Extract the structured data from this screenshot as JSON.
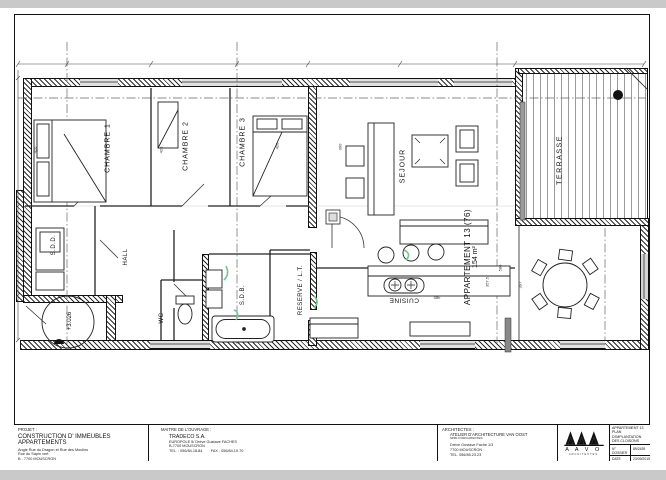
{
  "plan": {
    "rooms": {
      "chambre1": "CHAMBRE 1",
      "chambre2": "CHAMBRE 2",
      "chambre3": "CHAMBRE 3",
      "sejour": "SEJOUR",
      "terrasse": "TERRASSE",
      "hall": "HALL",
      "sdd": "S.D.D.",
      "wc": "WC",
      "sdb": "S.D.B.",
      "reserve": "RESERVE / L.T.",
      "cuisine": "CUISINE"
    },
    "apartment": {
      "name": "APPARTEMENT 13 (76)",
      "area": "154 m²"
    },
    "level_mark": "+3.026",
    "dims": [
      "420",
      "420",
      "420",
      "390",
      "580",
      "397",
      "357.5",
      "480"
    ]
  },
  "titleblock": {
    "projet": {
      "label": "PROJET :",
      "title": "CONSTRUCTION D' IMMEUBLES APPARTEMENTS",
      "line1": "Angle Rue du Dragon et Rue des Moulins",
      "line2": "Rue du Sapin vert",
      "line3": "B - 7700 MOUSCRON"
    },
    "maitre": {
      "label": "MAITRE DE L'OUVRAGE :",
      "name": "TRADECO S.A.",
      "line1": "EUROPOLE 5/ Drève Gustave FACHES",
      "line2": "B-7700 MOUSCRON",
      "line3": "TEL. : 056/84.18.84        FAX : 056/84.19.70"
    },
    "architectes": {
      "label": "ARCHITECTES :",
      "name": "ATELIER D'ARCHITECTURE VAN OOST",
      "subname": "SPRL D'ARCHITECTES",
      "line1": "Drève Gustave Fache 1/3",
      "line2": "7700 MOUSCRON",
      "line3": "TEL. 056/85.23.23"
    },
    "logo": {
      "letters": "A A V O",
      "sub": "ARCHITECTES"
    },
    "info": {
      "title_line1": "APPARTEMENT 13",
      "title_line2": "PLAN D'IMPLANTATION",
      "title_line3": "DES CLOISONS",
      "dossier_label": "N° DOSSIER",
      "dossier_value": "89/2439",
      "date_label": "DATE",
      "date_value": "23/09/2015",
      "ech_label": "ECH.",
      "ech_value": "1/50"
    }
  },
  "colors": {
    "paper": "#ffffff",
    "scan_background": "#c9c9c9",
    "line": "#1c1c1c",
    "annotation_green": "#6fc794"
  }
}
